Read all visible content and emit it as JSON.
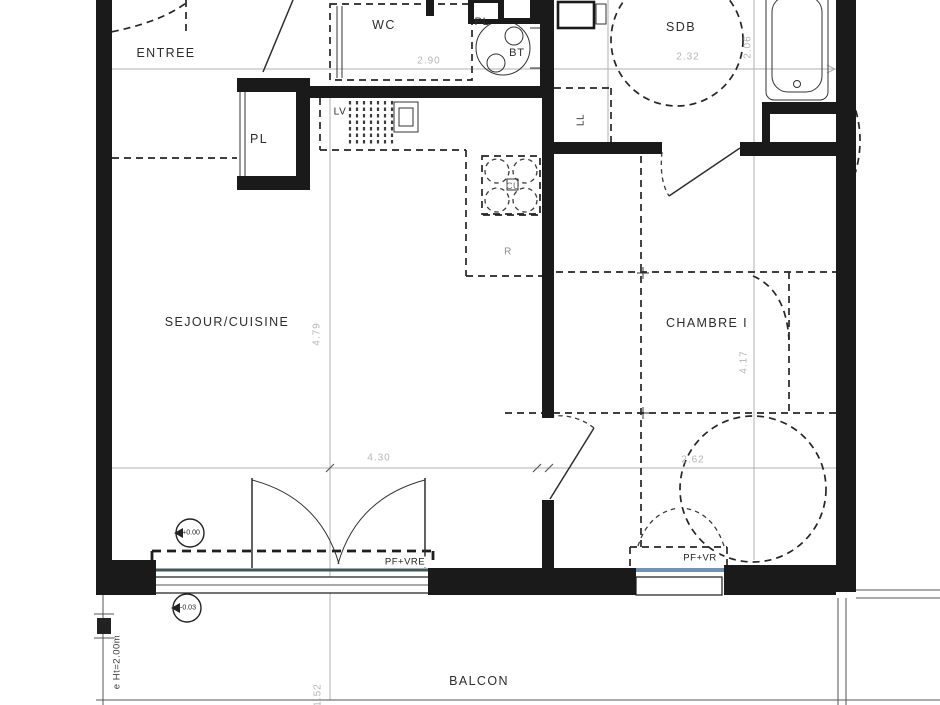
{
  "rooms": {
    "entree": "ENTREE",
    "wc": "WC",
    "sdb": "SDB",
    "sejour_cuisine": "SEJOUR/CUISINE",
    "chambre": "CHAMBRE I",
    "balcon": "BALCON"
  },
  "fixtures": {
    "pl_entree": "PL",
    "pl_sdb": "PL",
    "bt": "BT",
    "lv": "LV",
    "ll": "LL",
    "cu": "CU",
    "r": "R"
  },
  "openings": {
    "living_window": "PF+VRE",
    "bedroom_window": "PF+VR"
  },
  "levels": {
    "interior": "+0.00",
    "balcony": "-0.03"
  },
  "dimensions": {
    "wc_width": "2.90",
    "sdb_width": "2.32",
    "sdb_depth": "2.06",
    "sejour_depth": "4.79",
    "sejour_width": "4.30",
    "chambre_depth": "4.17",
    "chambre_width": "2.62",
    "balcon_depth": "1.52"
  },
  "annotations": {
    "separator_height": "e Ht=2.00m"
  },
  "colors": {
    "wall": "#1a1a1a",
    "dim_line": "#b0b0b0",
    "dim_text": "#b6b6b6",
    "label_text": "#2d2d2d",
    "glazing_living": "#41555a",
    "glazing_bedroom": "#7093b5"
  }
}
